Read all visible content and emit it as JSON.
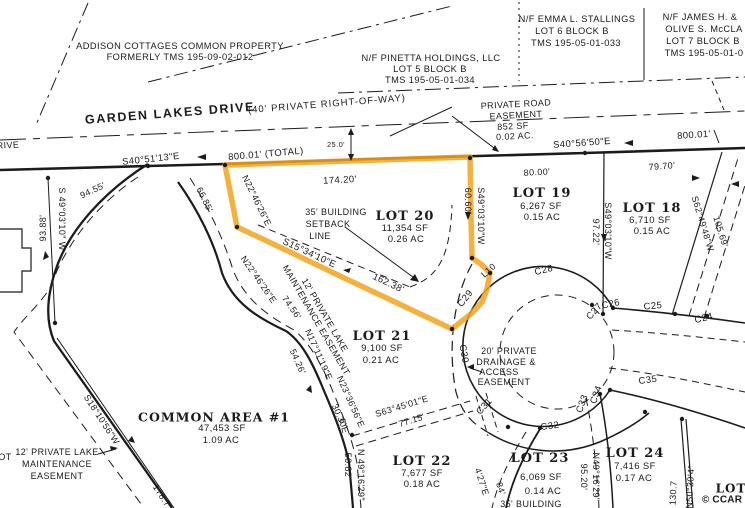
{
  "colors": {
    "highlight": "#F2A31B",
    "ink": "#1a1a1a",
    "background": "#ffffff"
  },
  "props": {
    "addison1": "ADDISON COTTAGES COMMON PROPERTY",
    "addison2": "FORMERLY TMS 195-09-02-012",
    "pinetta1": "N/F PINETTA HOLDINGS, LLC",
    "pinetta2": "LOT 5 BLOCK B",
    "pinetta3": "TMS 195-05-01-034",
    "stallings1": "N/F EMMA L. STALLINGS",
    "stallings2": "LOT 6 BLOCK B",
    "stallings3": "TMS 195-05-01-033",
    "james1": "N/F JAMES H. &",
    "james2": "OLIVE S. McCLA",
    "james3": "LOT 7 BLOCK B",
    "james4": "TMS 195-05-01-0"
  },
  "road": {
    "name": "GARDEN LAKES DRIVE",
    "row": "(40' PRIVATE RIGHT-OF-WAY)",
    "bearing_left": "S40°51'13\"E",
    "dist_left": "800.01' (TOTAL)",
    "offset": "25.0'",
    "bearing_right": "S40°56'50\"E",
    "dist_right": "800.01'",
    "easement": [
      "PRIVATE ROAD",
      "EASEMENT",
      "852 SF",
      "0.02 AC."
    ]
  },
  "lots": {
    "lot18": {
      "title": "LOT 18",
      "sf": "6,710 SF",
      "ac": "0.15 AC"
    },
    "lot19": {
      "title": "LOT 19",
      "sf": "6,267 SF",
      "ac": "0.15 AC"
    },
    "lot20": {
      "title": "LOT 20",
      "sf": "11,354 SF",
      "ac": "0.26 AC"
    },
    "lot21": {
      "title": "LOT 21",
      "sf": "9,100 SF",
      "ac": "0.21 AC"
    },
    "lot22": {
      "title": "LOT 22",
      "sf": "7,677 SF",
      "ac": "0.18 AC"
    },
    "lot23": {
      "title": "LOT 23",
      "sf": "6,069 SF",
      "ac": "0.14 AC"
    },
    "lot24": {
      "title": "LOT 24",
      "sf": "7,416 SF",
      "ac": "0.17 AC"
    },
    "lot25_frag": "LOT"
  },
  "common": {
    "title": "COMMON AREA #1",
    "sf": "47,453 SF",
    "ac": "1.09 AC"
  },
  "dims": {
    "d174": "174.20'",
    "d80": "80.00'",
    "d79": "79.70'",
    "d60": "60.60'",
    "b_s49a": "S49°03'10\"W",
    "b_s49b": "S49°03'10\"W",
    "d97": "97.22'",
    "b_s49c": "S 49°03'10\" W",
    "d93": "93.88'",
    "d94": "94.55'",
    "b_n22a": "N22°46'26\"E",
    "d66": "66.85'",
    "b_n22b": "N22°46'26\"E",
    "d74": "74.56'",
    "b_s15": "S15°34'10\"E",
    "d162": "162.38'",
    "b_s62": "S62°49'48\"W",
    "d105": "105.69'",
    "b_s18": "S18°10'56\"W",
    "d178": "178.7",
    "b_n17": "N17°11'19\"E",
    "d54": "54.26'",
    "b_n23": "N23°36'56\"E",
    "d30": "30.30'",
    "b_s63": "S63°45'01\"E",
    "d77": "77.15'",
    "b_n49a": "N 49°16'29\"",
    "d50": "50.82'",
    "b_n49b": "N49°16'29\"",
    "d95": "95.20'",
    "b_s34": "4'27\"E",
    "d84": "84'",
    "b_n50": "N50°30'4\"",
    "d130": "130.7",
    "frag6": "6\"E"
  },
  "curves": {
    "c24": "C24",
    "c25": "C25",
    "c26": "C26",
    "c27": "C27",
    "c28": "C28",
    "c29": "C29",
    "c30": "C30",
    "c31": "C31",
    "c32": "C32",
    "c33": "C33",
    "c34": "C34",
    "c35": "C35",
    "l10": "L10"
  },
  "ease": {
    "drain1": "20' PRIVATE",
    "drain2": "DRAINAGE &",
    "drain3": "ACCESS",
    "drain4": "EASEMENT",
    "lakebl1": "12' PRIVATE LAKE",
    "lakebl2": "MAINTENANCE",
    "lakebl3": "EASEMENT",
    "laked1": "12' PRIVATE LAKE",
    "laked2": "MAINTENANCE EASEMENT",
    "set1": "35' BUILDING",
    "set2": "SETBACK",
    "set3": "LINE",
    "set23": "35' BUILDING"
  },
  "frags": {
    "ot": "OT",
    "rive": "RIVE"
  },
  "footer": {
    "credit": "© CCAR"
  }
}
